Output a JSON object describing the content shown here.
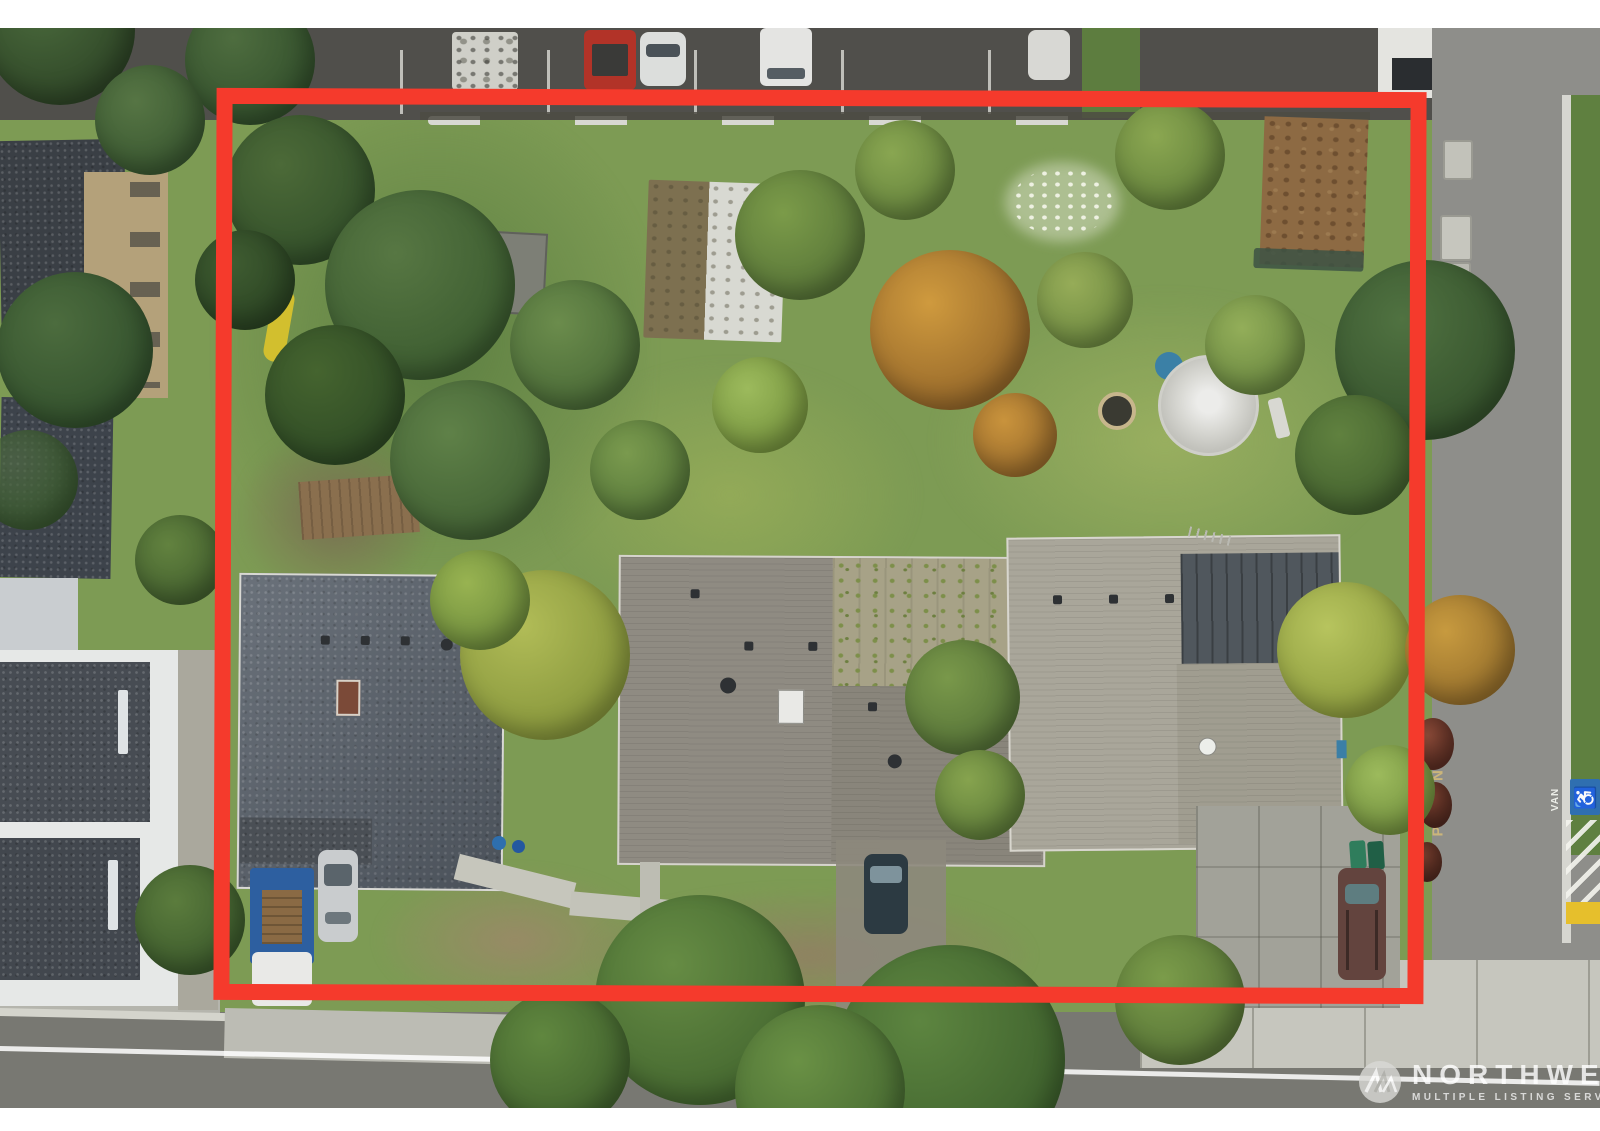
{
  "scene": {
    "type": "aerial-drone-real-estate-photo",
    "frame_color": "#ffffff",
    "boundary_color": "#f53a2c"
  },
  "street_markings": {
    "parking": "PARKING",
    "van": "VAN",
    "accessible_symbol": "♿"
  },
  "watermark": {
    "brand": "NORTHWEST",
    "tagline": "MULTIPLE LISTING SERVICE"
  },
  "colors": {
    "accessible_parking_blue": "#2f6fb0",
    "curb_ramp_yellow": "#e6bf2c",
    "lawn_green": "#7d9b54",
    "asphalt_gray": "#8e8e8a",
    "parking_stencil_tan": "#cfb87a"
  }
}
